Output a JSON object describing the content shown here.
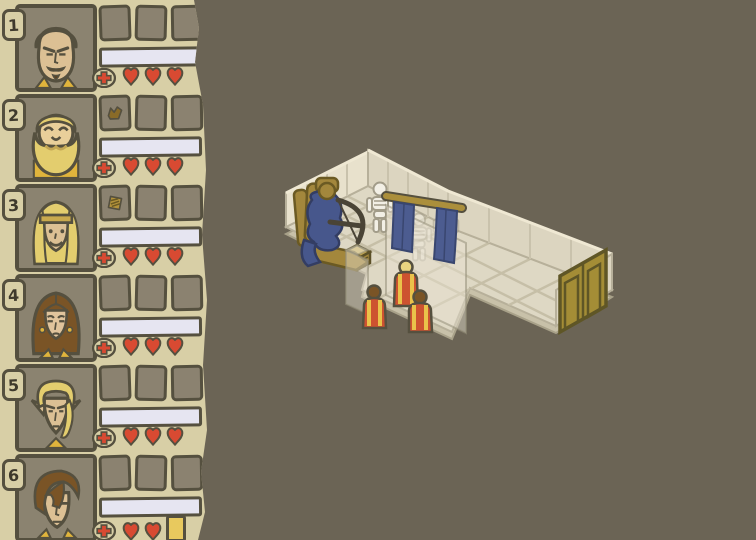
{
  "palette": {
    "background": "#6b6455",
    "sidebar_bg": "#d8cfa6",
    "outline": "#55503f",
    "panel_slot": "#8b8270",
    "bar_fill": "#e6e5f1",
    "heart_red": "#d84a32",
    "gold_trim": "#e0b43c",
    "gold_token": "#e8c95e",
    "room_wall": "#dcd5c0",
    "room_wall_lit": "#e8e1cc",
    "room_floor": "#ded8c4",
    "floor_grid": "#c6bfa7",
    "curtain_blue": "#4c5c90",
    "door_gold": "#a48d36",
    "throne_gold": "#a3873c",
    "figure_blue": "#47578c",
    "skeleton_white": "#f2efe5",
    "robe_red": "#cd5230",
    "robe_stripe": "#eac24a"
  },
  "sidebar": {
    "characters": [
      {
        "number": "1",
        "portrait": "portrait-stern-man",
        "slots": [
          null,
          null,
          null
        ],
        "bar_value": "",
        "hearts": 3,
        "extra": null
      },
      {
        "number": "2",
        "portrait": "portrait-bearded-dwarf",
        "slots": [
          "brown-item",
          null,
          null
        ],
        "bar_value": "",
        "hearts": 3,
        "extra": null
      },
      {
        "number": "3",
        "portrait": "portrait-blond-headband",
        "slots": [
          "gold-striped-item",
          null,
          null
        ],
        "bar_value": "",
        "hearts": 3,
        "extra": null
      },
      {
        "number": "4",
        "portrait": "portrait-brown-haired-woman",
        "slots": [
          null,
          null,
          null
        ],
        "bar_value": "",
        "hearts": 3,
        "extra": null
      },
      {
        "number": "5",
        "portrait": "portrait-blond-elf",
        "slots": [
          null,
          null,
          null
        ],
        "bar_value": "",
        "hearts": 3,
        "extra": null
      },
      {
        "number": "6",
        "portrait": "portrait-fringe-man",
        "slots": [
          null,
          null,
          null
        ],
        "bar_value": "",
        "hearts": 2,
        "extra": "gold-token"
      }
    ]
  },
  "scene": {
    "entities": [
      "throne",
      "seated-blue-figure",
      "crossbow",
      "skeleton",
      "faded-skeleton",
      "faded-skeleton",
      "curtain-rod",
      "curtain-left",
      "curtain-right",
      "chest",
      "glass-panel",
      "glass-pillar",
      "party-member-blond",
      "party-member-left",
      "party-member-right",
      "double-door"
    ]
  }
}
